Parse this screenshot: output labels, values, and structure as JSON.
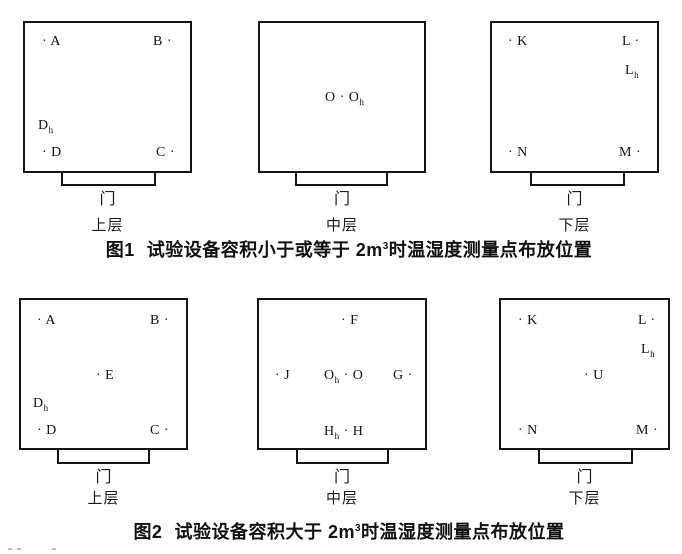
{
  "colors": {
    "ink": "#141414",
    "paper": "#ffffff"
  },
  "labels": {
    "door": "门"
  },
  "figures": [
    {
      "name": "figure-1",
      "caption": {
        "prefix": "图1",
        "body": "试验设备容积小于或等于 2m",
        "sup": "3",
        "rest": "时温湿度测量点布放位置"
      },
      "panels": [
        {
          "key": "upper-layer",
          "layer": "上层",
          "box": {
            "x": 23,
            "y": 21,
            "w": 169,
            "h": 152
          },
          "door": {
            "x": 61,
            "w": 95,
            "h": 13
          },
          "door_label_y": 192,
          "layer_label_y": 218,
          "points": [
            {
              "name": "A",
              "t1": "· A",
              "x": 42,
              "y": 42
            },
            {
              "name": "B",
              "t1": "B ·",
              "x": 153,
              "y": 42
            },
            {
              "name": "Dh",
              "t1": "D",
              "sub": "h",
              "x": 38,
              "y": 126
            },
            {
              "name": "D",
              "t1": "· D",
              "x": 42,
              "y": 153
            },
            {
              "name": "C",
              "t1": "C ·",
              "x": 156,
              "y": 153
            }
          ]
        },
        {
          "key": "middle-layer",
          "layer": "中层",
          "box": {
            "x": 258,
            "y": 21,
            "w": 168,
            "h": 152
          },
          "door": {
            "x": 295,
            "w": 93,
            "h": 13
          },
          "door_label_y": 192,
          "layer_label_y": 218,
          "points": [
            {
              "name": "O-Oh",
              "t1": "O · O",
              "sub": "h",
              "x": 325,
              "y": 98
            }
          ]
        },
        {
          "key": "lower-layer",
          "layer": "下层",
          "box": {
            "x": 490,
            "y": 21,
            "w": 169,
            "h": 152
          },
          "door": {
            "x": 530,
            "w": 95,
            "h": 13
          },
          "door_label_y": 192,
          "layer_label_y": 218,
          "points": [
            {
              "name": "K",
              "t1": "· K",
              "x": 508,
              "y": 42
            },
            {
              "name": "L",
              "t1": "L ·",
              "x": 622,
              "y": 42
            },
            {
              "name": "Lh",
              "t1": "L",
              "sub": "h",
              "x": 625,
              "y": 71
            },
            {
              "name": "N",
              "t1": "· N",
              "x": 508,
              "y": 153
            },
            {
              "name": "M",
              "t1": "M ·",
              "x": 619,
              "y": 153
            }
          ]
        }
      ]
    },
    {
      "name": "figure-2",
      "caption": {
        "prefix": "图2",
        "body": "试验设备容积大于 2m",
        "sup": "3",
        "rest": "时温湿度测量点布放位置"
      },
      "panels": [
        {
          "key": "upper-layer",
          "layer": "上层",
          "box": {
            "x": 19,
            "y": 298,
            "w": 169,
            "h": 152
          },
          "door": {
            "x": 57,
            "w": 93,
            "h": 14
          },
          "door_label_y": 470,
          "layer_label_y": 491,
          "points": [
            {
              "name": "A",
              "t1": "· A",
              "x": 37,
              "y": 321
            },
            {
              "name": "B",
              "t1": "B ·",
              "x": 150,
              "y": 321
            },
            {
              "name": "E",
              "t1": "· E",
              "x": 96,
              "y": 376
            },
            {
              "name": "Dh",
              "t1": "D",
              "sub": "h",
              "x": 33,
              "y": 404
            },
            {
              "name": "D",
              "t1": "· D",
              "x": 37,
              "y": 431
            },
            {
              "name": "C",
              "t1": "C ·",
              "x": 150,
              "y": 431
            }
          ]
        },
        {
          "key": "middle-layer",
          "layer": "中层",
          "box": {
            "x": 257,
            "y": 298,
            "w": 170,
            "h": 152
          },
          "door": {
            "x": 296,
            "w": 93,
            "h": 14
          },
          "door_label_y": 470,
          "layer_label_y": 491,
          "points": [
            {
              "name": "F",
              "t1": "· F",
              "x": 341,
              "y": 321
            },
            {
              "name": "J",
              "t1": "· J",
              "x": 275,
              "y": 376
            },
            {
              "name": "Oh-O",
              "t1": "O",
              "sub": "h",
              "t2": " · O",
              "x": 324,
              "y": 376
            },
            {
              "name": "G",
              "t1": "G ·",
              "x": 393,
              "y": 376
            },
            {
              "name": "Hh-H",
              "t1": "H",
              "sub": "h",
              "t2": " · H",
              "x": 324,
              "y": 432
            }
          ]
        },
        {
          "key": "lower-layer",
          "layer": "下层",
          "box": {
            "x": 499,
            "y": 298,
            "w": 171,
            "h": 152
          },
          "door": {
            "x": 538,
            "w": 95,
            "h": 14
          },
          "door_label_y": 470,
          "layer_label_y": 491,
          "points": [
            {
              "name": "K",
              "t1": "· K",
              "x": 518,
              "y": 321
            },
            {
              "name": "L",
              "t1": "L ·",
              "x": 638,
              "y": 321
            },
            {
              "name": "Lh",
              "t1": "L",
              "sub": "h",
              "x": 641,
              "y": 350
            },
            {
              "name": "U",
              "t1": "· U",
              "x": 584,
              "y": 376
            },
            {
              "name": "N",
              "t1": "· N",
              "x": 518,
              "y": 431
            },
            {
              "name": "M",
              "t1": "M ·",
              "x": 636,
              "y": 431
            }
          ]
        }
      ]
    }
  ],
  "artifacts": [
    {
      "x": 8,
      "y": 548
    },
    {
      "x": 17,
      "y": 548
    },
    {
      "x": 52,
      "y": 548
    }
  ]
}
